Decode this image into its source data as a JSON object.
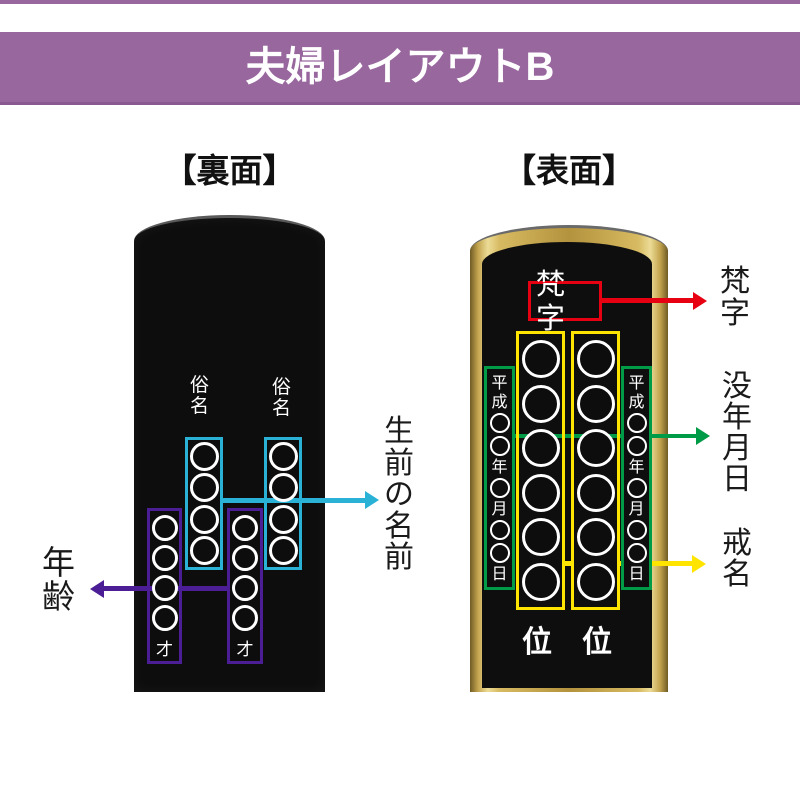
{
  "header": {
    "title": "夫婦レイアウトB"
  },
  "back": {
    "section_title": "【裏面】",
    "name_label_left": "俗名",
    "name_label_right": "俗名",
    "age_suffix_left": "才",
    "age_suffix_right": "才",
    "name_circle_count": 4,
    "age_circle_count": 4,
    "annotation_age": "年齢",
    "annotation_lifetime_name": "生前の名前"
  },
  "front": {
    "section_title": "【表面】",
    "bonji_box_text": "梵字",
    "date_tokens": "平成○○年○月○○日",
    "kaimyo_circle_count": 6,
    "rank": [
      "位",
      "位"
    ],
    "annotation_bonji": "梵字",
    "annotation_death_date": "没年月日",
    "annotation_kaimyo": "戒名"
  },
  "colors": {
    "header_bg": "#98679E",
    "lifetime_name_accent": "#29B2D6",
    "age_accent": "#4B1E96",
    "bonji_accent": "#E60012",
    "death_date_accent": "#009B46",
    "kaimyo_accent": "#FFE400",
    "tablet_black": "#0D0D0D",
    "tablet_gold": "#C9A84E"
  }
}
